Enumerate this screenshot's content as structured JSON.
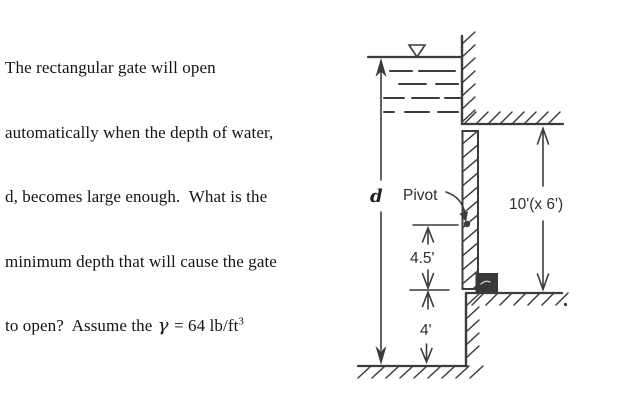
{
  "problem_text": {
    "line1": "The rectangular gate will open",
    "line2": "automatically when the depth of water,",
    "line3": "d, becomes large enough.  What is the",
    "line4": "minimum depth that will cause the gate",
    "line5_prefix": "to open?  Assume the ",
    "gamma": "γ",
    "line5_equation": " = 64 lb/ft",
    "line5_exponent": "3"
  },
  "figure": {
    "labels": {
      "depth": "d",
      "pivot": "Pivot",
      "pivot_to_gate_bottom": "4.5'",
      "gate_bottom_to_floor": "4'",
      "gate_size": "10'(x 6')"
    },
    "colors": {
      "ink": "#3c3c3c",
      "stop_fill": "#383838",
      "background": "#ffffff"
    }
  }
}
